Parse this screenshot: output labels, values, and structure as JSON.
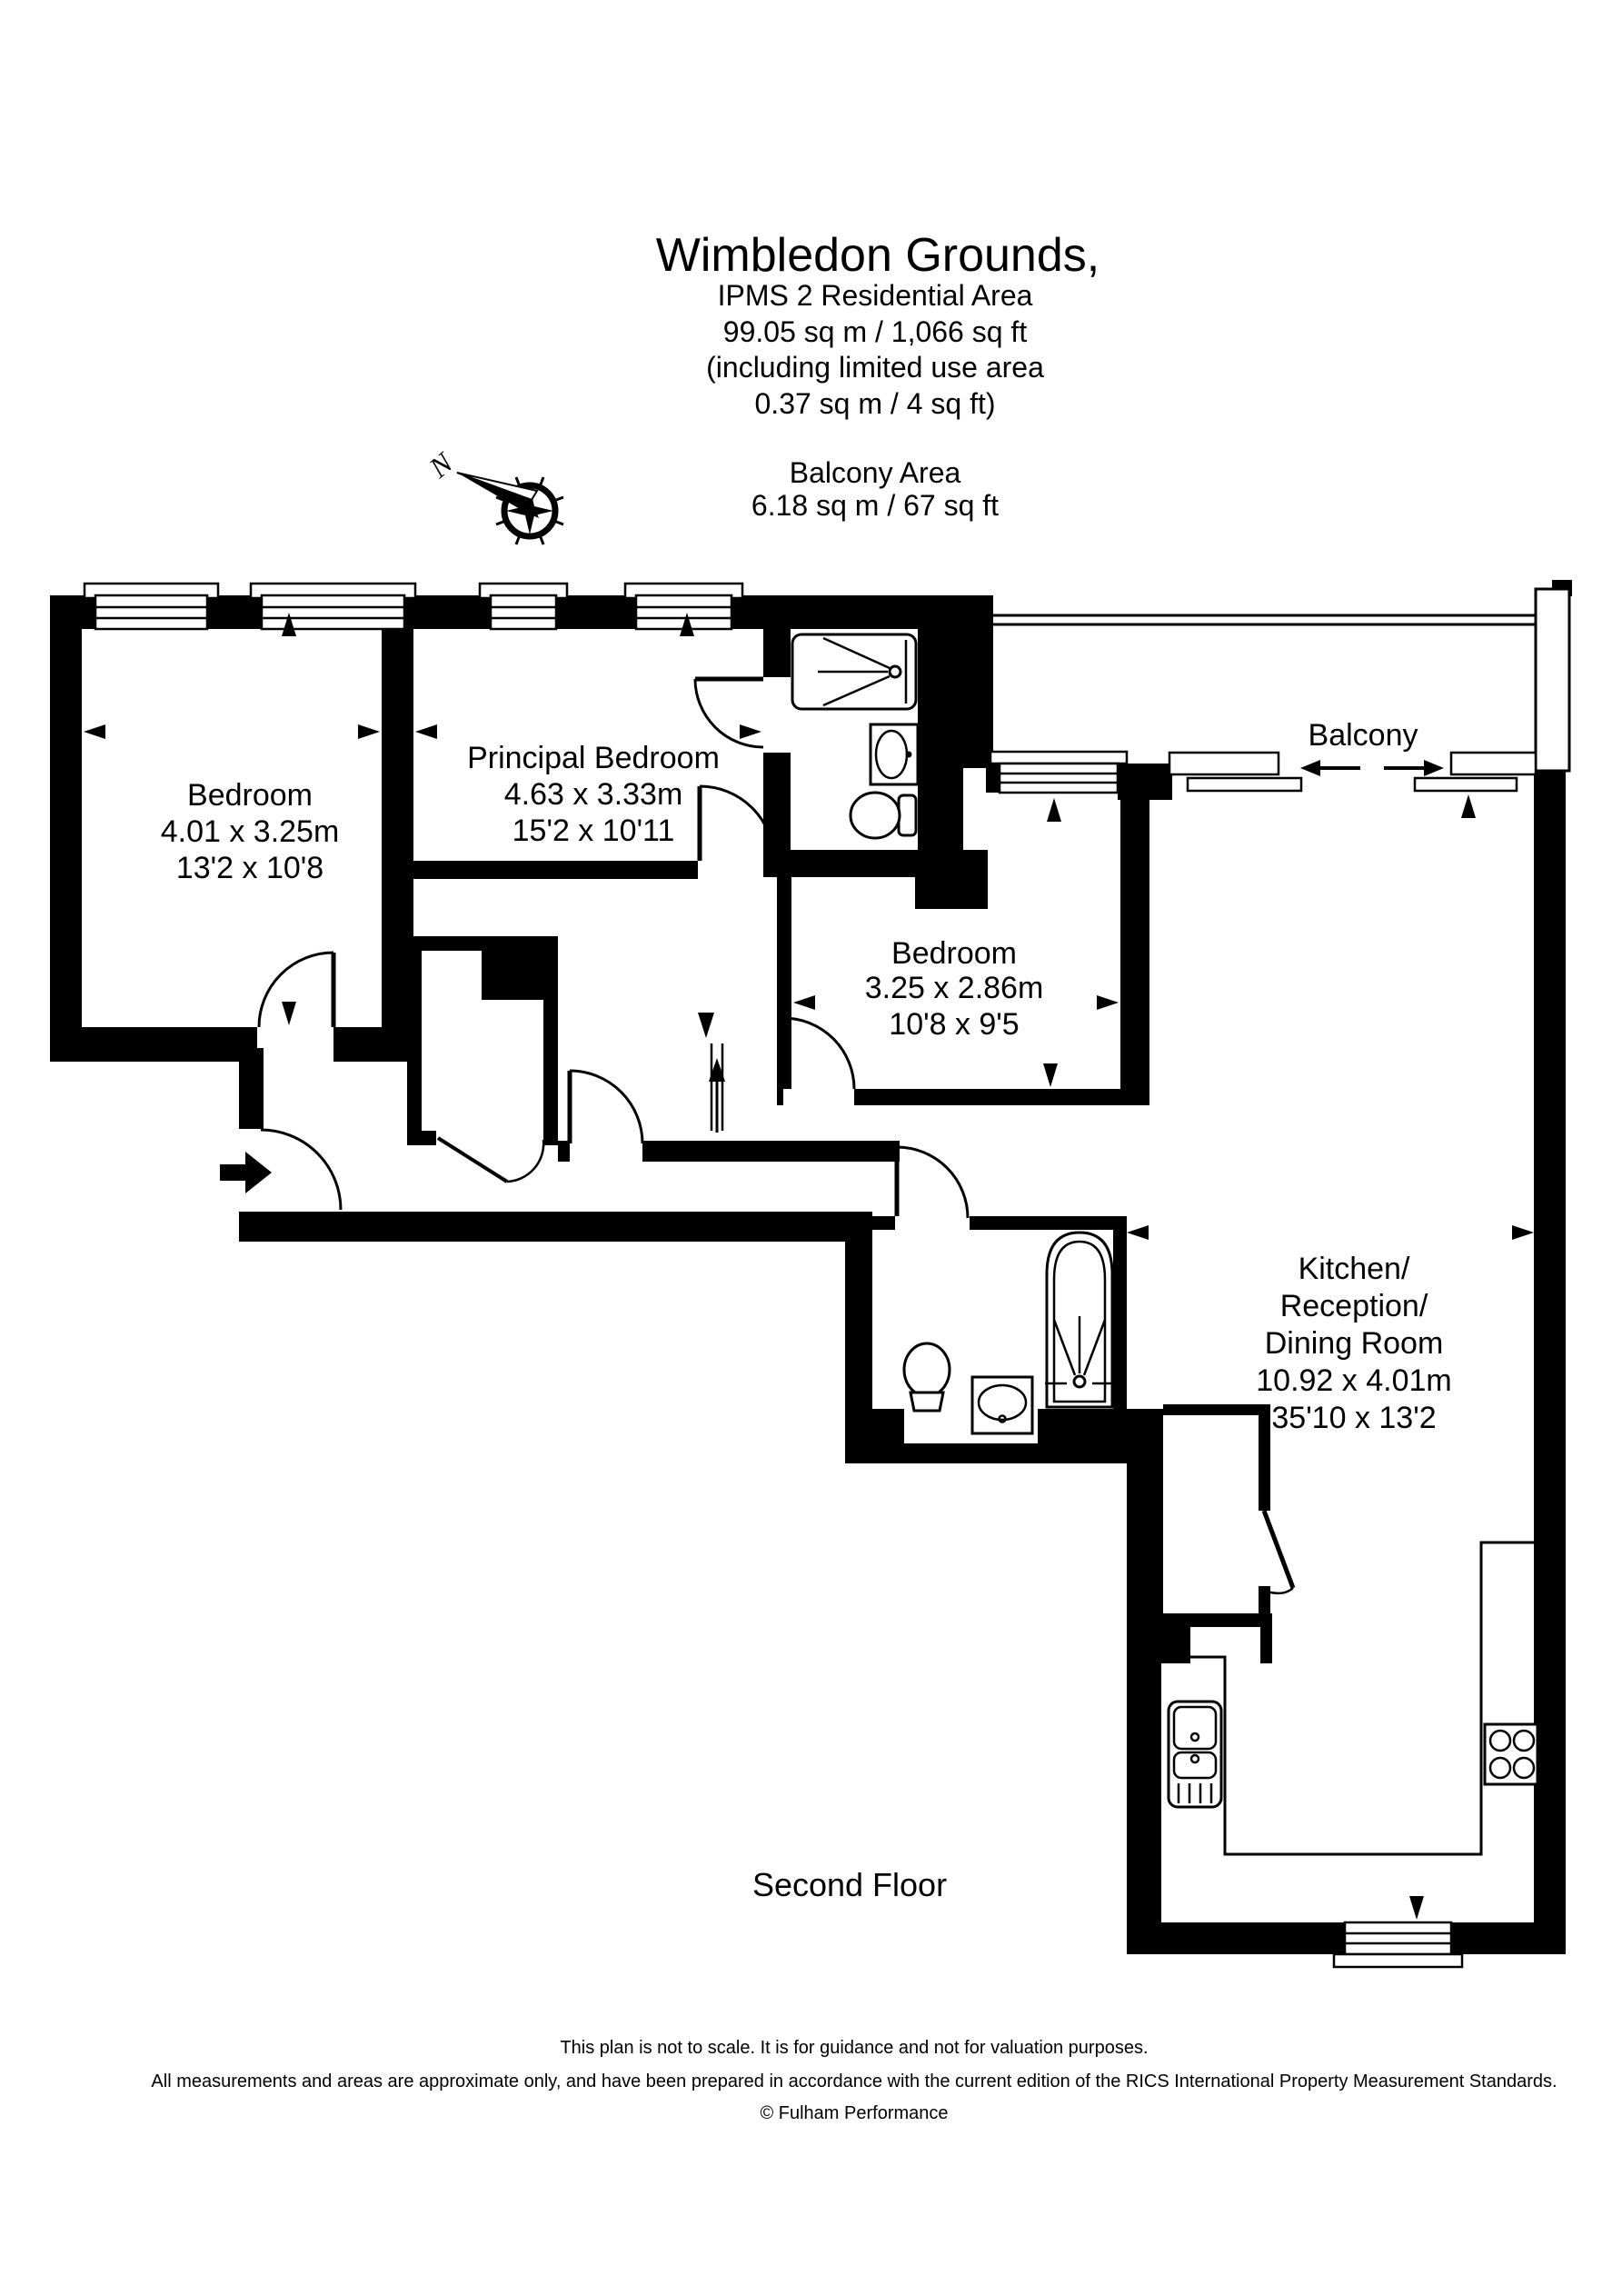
{
  "header": {
    "title": "Wimbledon Grounds,",
    "line1": "IPMS 2 Residential Area",
    "line2": "99.05 sq m  /  1,066 sq ft",
    "line3": "(including limited use area",
    "line4": "0.37 sq m  /  4 sq ft)",
    "balcony_title": "Balcony Area",
    "balcony_line": "6.18 sq m  /  67 sq ft"
  },
  "compass": {
    "north_label": "N"
  },
  "rooms": {
    "bedroom1": {
      "name": "Bedroom",
      "metric": "4.01 x 3.25m",
      "imperial": "13'2 x 10'8"
    },
    "principal": {
      "name": "Principal Bedroom",
      "metric": "4.63 x 3.33m",
      "imperial": "15'2 x 10'11"
    },
    "bedroom2": {
      "name": "Bedroom",
      "metric": "3.25 x 2.86m",
      "imperial": "10'8 x 9'5"
    },
    "balcony": {
      "name": "Balcony"
    },
    "kitchen": {
      "name_line1": "Kitchen/",
      "name_line2": "Reception/",
      "name_line3": "Dining Room",
      "metric": "10.92 x 4.01m",
      "imperial": "35'10 x 13'2"
    }
  },
  "floor_label": "Second Floor",
  "footer": {
    "line1": "This plan is not to scale. It is for guidance and not for valuation purposes.",
    "line2": "All measurements and areas are approximate only, and have been prepared in accordance with the current edition of the RICS International Property Measurement Standards.",
    "line3": "© Fulham Performance"
  },
  "colors": {
    "wall": "#000000",
    "background": "#ffffff"
  }
}
